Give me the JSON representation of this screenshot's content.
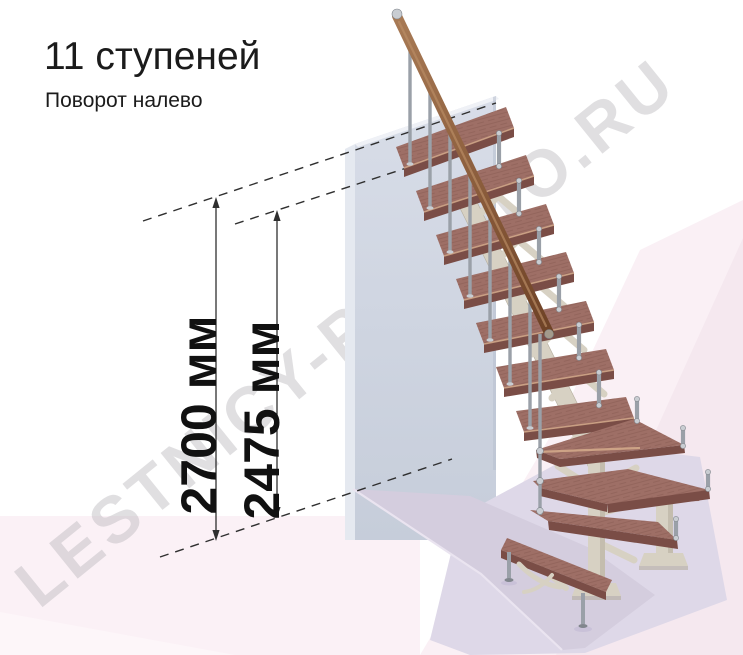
{
  "title": "11 ступеней",
  "subtitle": "Поворот налево",
  "watermark": "LESTNICY-PROSTO.RU",
  "dimensions": {
    "total_height": {
      "label": "2700 мм",
      "value_mm": 2700
    },
    "upper_height": {
      "label": "2475 мм",
      "value_mm": 2475
    }
  },
  "stairs": {
    "steps_total": 11,
    "straight_steps": 7,
    "winder_steps": 3,
    "bottom_straight_steps": 1,
    "turn_direction": "налево"
  },
  "colors": {
    "wood_top": "#9e6f66",
    "wood_front": "#7a4d46",
    "wood_edge": "#d3a98a",
    "wood_grain": "#7e524b",
    "metal": "#9aa0a8",
    "metal_light": "#c9cdd2",
    "metal_dark": "#81868d",
    "frame": "#d7d1c3",
    "frame_dark": "#b4ad9d",
    "rail_light": "#a87a55",
    "rail_dark": "#6e4226",
    "wall_side": "#e5e9f0",
    "wall_top_edge": "#eff1f6",
    "wall_right_edge": "#b9c1d0",
    "floor_top": "#ded8e8",
    "floor_shadow": "#d4cdde",
    "floor_bevel": "#eae4f0",
    "bg_pink_left": "#fbf1f6",
    "bg_pink_right": "#faf0f5",
    "bg_pink_deep": "#f5e8ef",
    "bg_pink_corner": "#fdf6f9",
    "dim_line": "#2f2f2f",
    "text": "#1b1b1b",
    "watermark_gray": "rgba(182,178,183,0.42)"
  }
}
